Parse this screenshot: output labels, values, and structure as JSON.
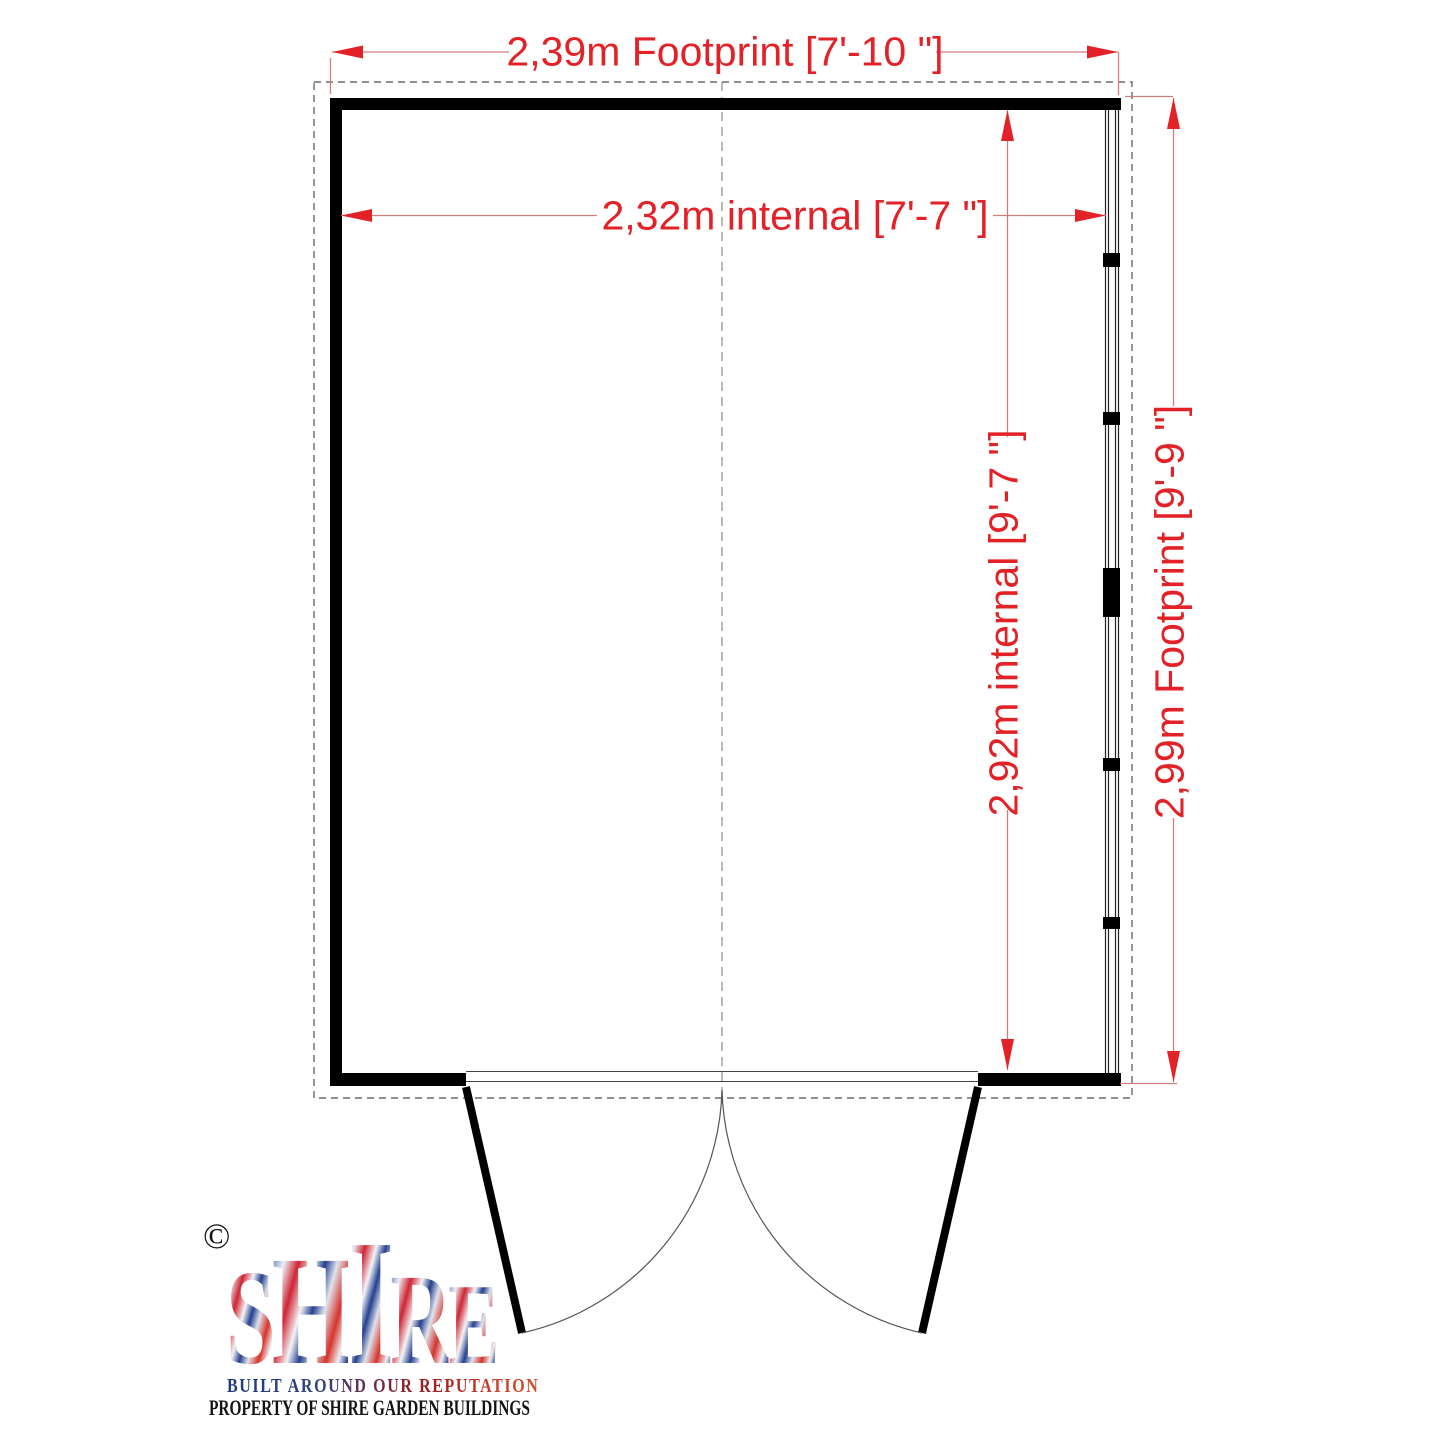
{
  "drawing": {
    "dim_width_footprint": "2,39m Footprint [7'-10 \"]",
    "dim_width_internal": "2,32m internal [7'-7 \"]",
    "dim_depth_internal": "2,92m internal [9'-7 \"]",
    "dim_depth_footprint": "2,99m Footprint [9'-9 \"]"
  },
  "logo": {
    "copyright": "©",
    "brand": "SHIRE",
    "letters": [
      "S",
      "H",
      "I",
      "R",
      "E"
    ],
    "tagline": "BUILT AROUND OUR REPUTATION",
    "property_line": "PROPERTY OF SHIRE GARDEN BUILDINGS"
  },
  "colors": {
    "dimension_red": "#e32227",
    "dimension_line_red": "#d07f7b",
    "wall_black": "#000000",
    "footprint_dash_gray": "#6a6a6a"
  }
}
